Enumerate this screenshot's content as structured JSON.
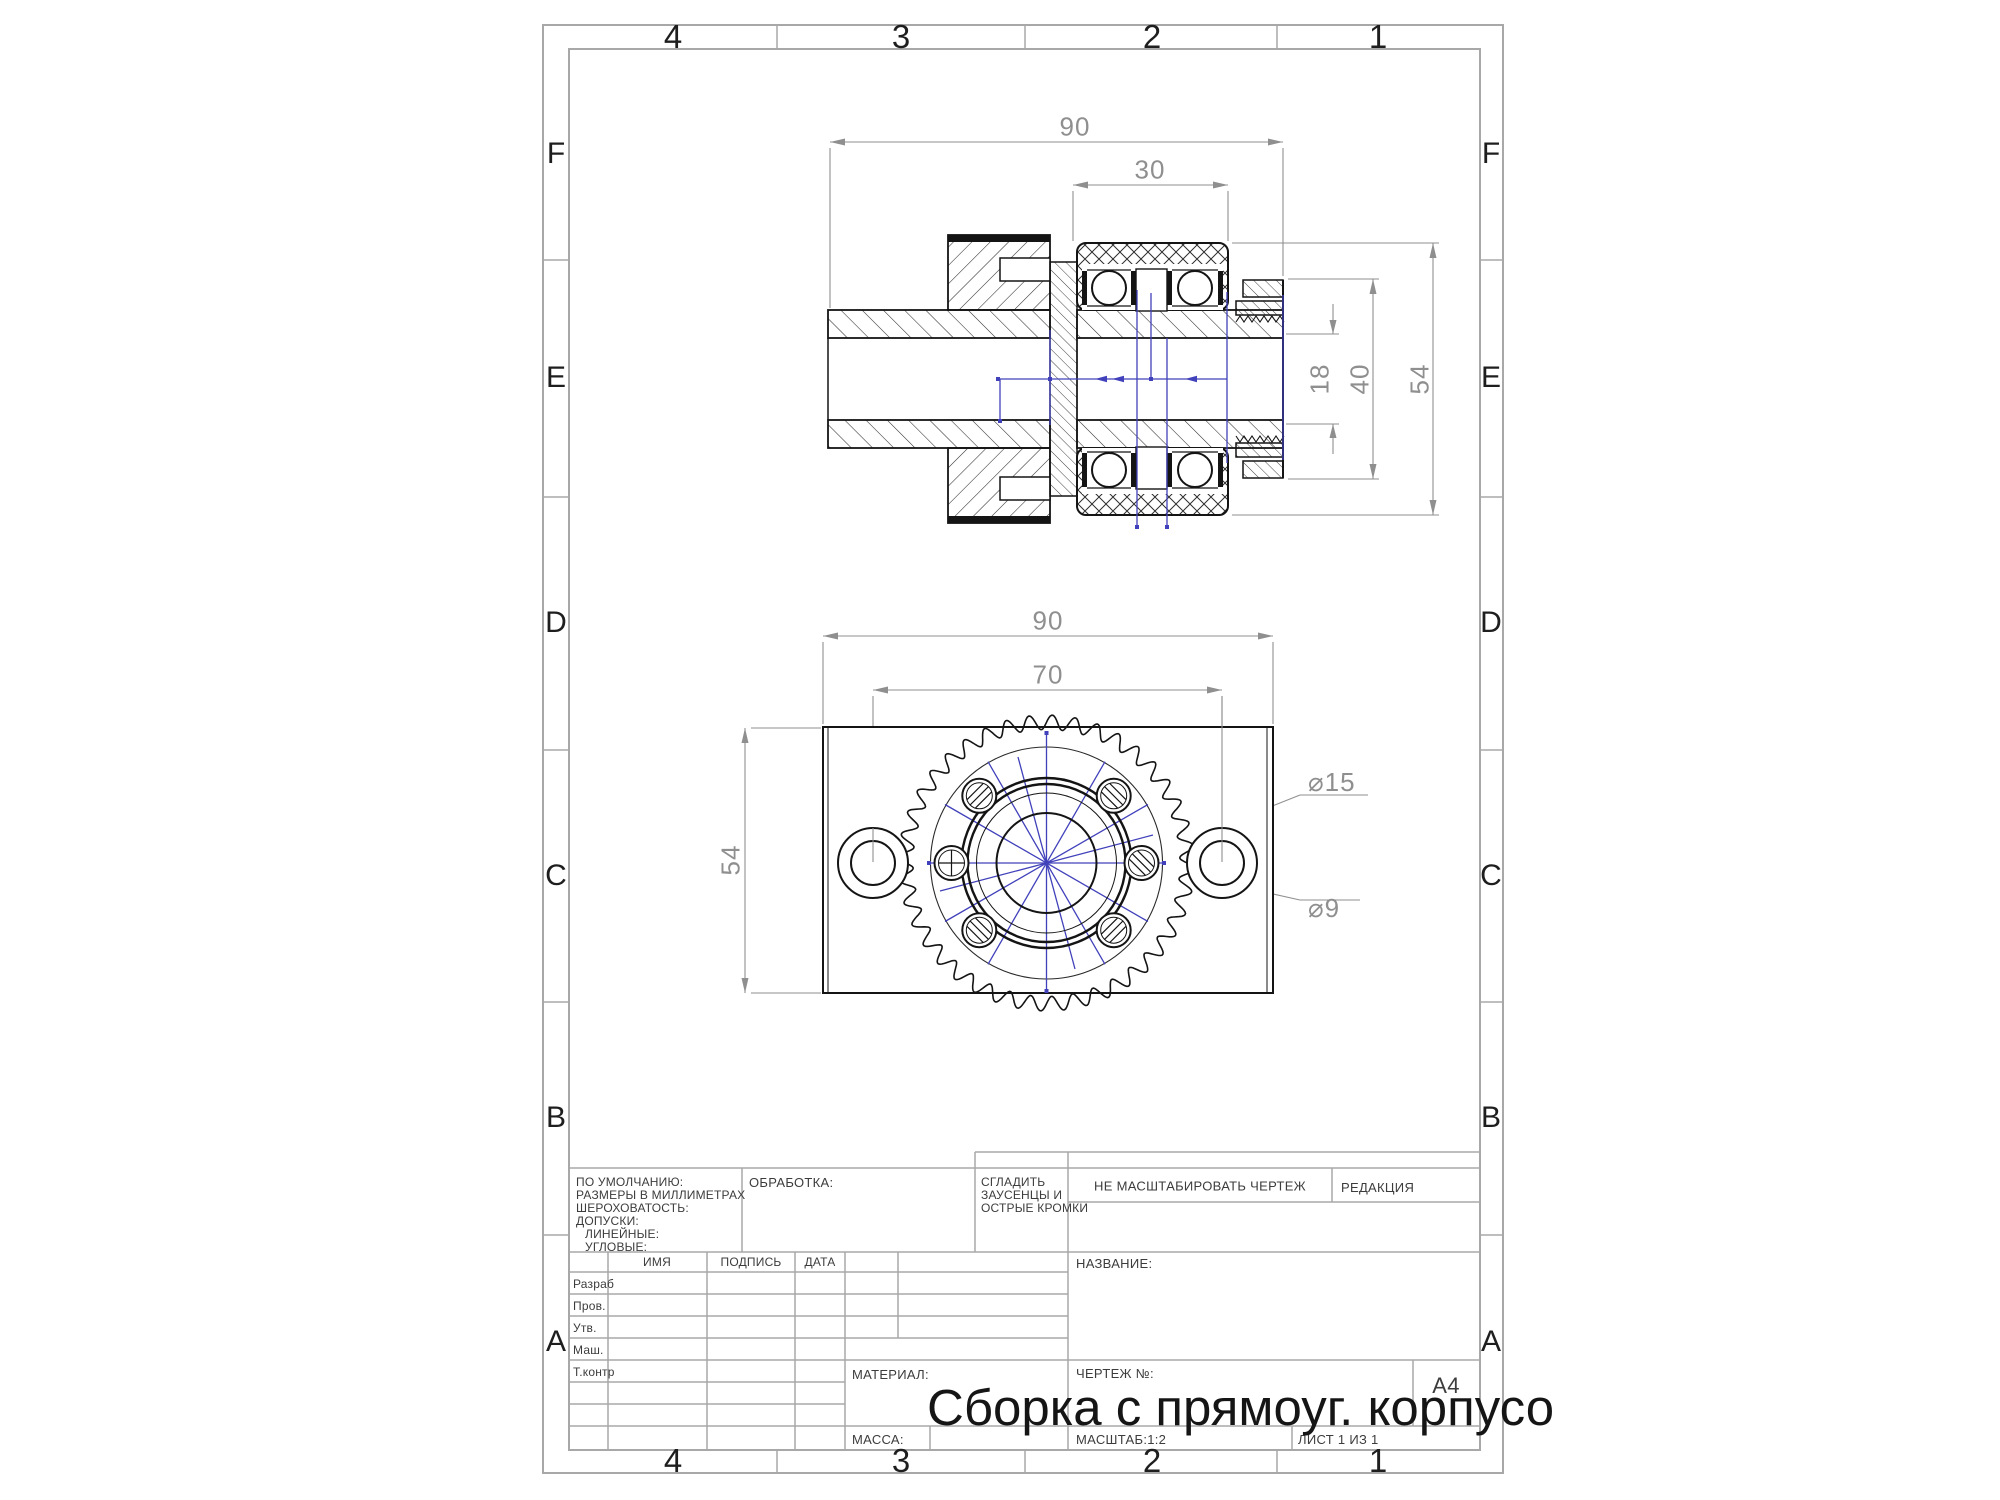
{
  "grid": {
    "cols": [
      "4",
      "3",
      "2",
      "1"
    ],
    "rows": [
      "F",
      "E",
      "D",
      "C",
      "B",
      "A"
    ]
  },
  "section_view_dims": {
    "w_total": "90",
    "w_bearing": "30",
    "d_bore": "18",
    "d_housing": "40",
    "d_outer": "54"
  },
  "front_view_dims": {
    "w_total": "90",
    "hole_span": "70",
    "height": "54",
    "d_boss": "⌀15",
    "d_hole": "⌀9"
  },
  "titleblock": {
    "defaults_lines": [
      "ПО УМОЛЧАНИЮ:",
      "РАЗМЕРЫ В МИЛЛИМЕТРАХ",
      "ШЕРОХОВАТОСТЬ:",
      "ДОПУСКИ:",
      "ЛИНЕЙНЫЕ:",
      "УГЛОВЫЕ:"
    ],
    "obrabotka": "ОБРАБОТКА:",
    "sgladit_lines": [
      "СГЛАДИТЬ",
      "ЗАУСЕНЦЫ И",
      "ОСТРЫЕ КРОМКИ"
    ],
    "ne_masshtabirovat": "НЕ МАСШТАБИРОВАТЬ ЧЕРТЕЖ",
    "redakcia": "РЕДАКЦИЯ",
    "col_imya": "ИМЯ",
    "col_podpis": "ПОДПИСЬ",
    "col_data": "ДАТА",
    "rows": [
      "Разраб",
      "Пров.",
      "Утв.",
      "Маш.",
      "Т.контр"
    ],
    "nazvanie": "НАЗВАНИЕ:",
    "material": "МАТЕРИАЛ:",
    "massa": "МАССА:",
    "chertezh_no": "ЧЕРТЕЖ №:",
    "format": "A4",
    "masshtab": "МАСШТАБ:1:2",
    "list": "ЛИСТ 1 ИЗ 1",
    "title_overlay": "Сборка с прямоуг. корпусо"
  },
  "colors": {
    "line": "#141414",
    "hatch": "#2e2e2e",
    "dim": "#8f8f8f",
    "frame": "#a8a8a8",
    "centerline_blue": "#4141bb"
  }
}
